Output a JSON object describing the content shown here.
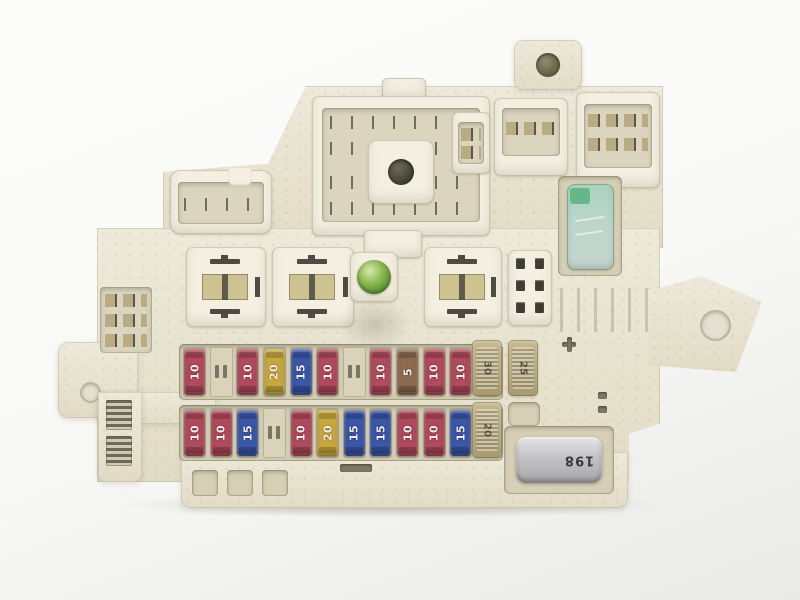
{
  "scene": {
    "subject": "Automotive interior fuse and relay box photographed on a light background",
    "background_color": "#f8f8f6",
    "housing_color": "#eae5d3"
  },
  "colors": {
    "fuse_red_10a": "#b04a5c",
    "fuse_blue_15a": "#3a57a8",
    "fuse_yellow_20a": "#c8a83e",
    "fuse_tan_5a": "#8d6b50",
    "cartridge_fuse": "#b3a47c",
    "green_relay": "#9ecab3",
    "green_bolt": "#7cb84a",
    "silver_relay": "#c4c4c6"
  },
  "fuse_rows": [
    {
      "name": "upper-row",
      "slots": [
        {
          "amp": "10",
          "hex": "#b04a5c"
        },
        {
          "empty": true
        },
        {
          "amp": "10",
          "hex": "#b04a5c"
        },
        {
          "amp": "20",
          "hex": "#c8a83e"
        },
        {
          "amp": "15",
          "hex": "#3a57a8"
        },
        {
          "amp": "10",
          "hex": "#b04a5c"
        },
        {
          "empty": true
        },
        {
          "amp": "10",
          "hex": "#b04a5c"
        },
        {
          "amp": "5",
          "hex": "#8d6b50"
        },
        {
          "amp": "10",
          "hex": "#b04a5c"
        },
        {
          "amp": "10",
          "hex": "#b04a5c"
        },
        {
          "amp": "10",
          "hex": "#b04a5c"
        }
      ]
    },
    {
      "name": "lower-row",
      "slots": [
        {
          "amp": "10",
          "hex": "#b04a5c"
        },
        {
          "amp": "10",
          "hex": "#b04a5c"
        },
        {
          "amp": "15",
          "hex": "#3a57a8"
        },
        {
          "empty": true
        },
        {
          "amp": "10",
          "hex": "#b04a5c"
        },
        {
          "amp": "20",
          "hex": "#c8a83e"
        },
        {
          "amp": "15",
          "hex": "#3a57a8"
        },
        {
          "amp": "15",
          "hex": "#3a57a8"
        },
        {
          "amp": "10",
          "hex": "#b04a5c"
        },
        {
          "amp": "10",
          "hex": "#b04a5c"
        },
        {
          "amp": "15",
          "hex": "#3a57a8"
        },
        {
          "amp": "10",
          "hex": "#b04a5c"
        }
      ]
    }
  ],
  "cartridge_fuses": [
    {
      "amp": "30"
    },
    {
      "amp": "25"
    },
    {
      "amp": "20"
    }
  ],
  "components": {
    "silver_relay_label": "198"
  }
}
